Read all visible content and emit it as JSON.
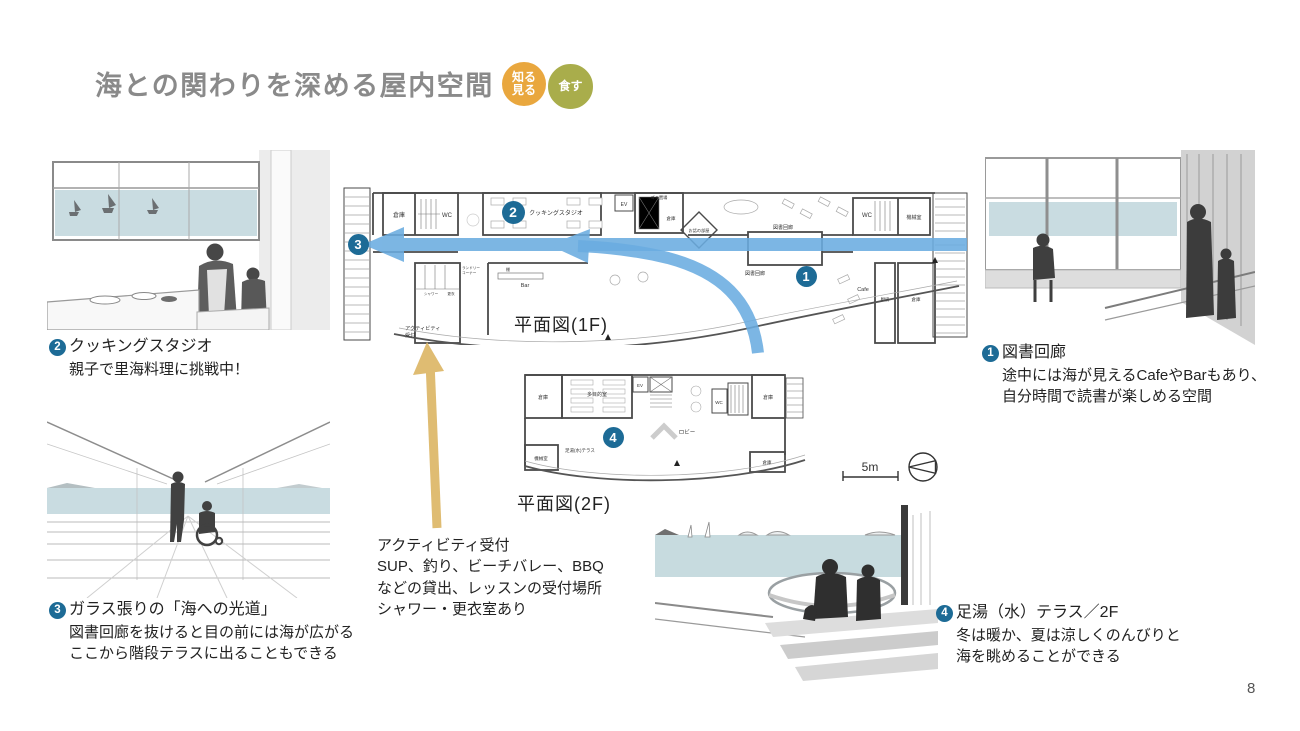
{
  "page": {
    "number": "8"
  },
  "title": {
    "text": "海との関わりを深める屋内空間"
  },
  "badges": [
    {
      "line1": "知る",
      "line2": "見る",
      "color": "#e9a73e"
    },
    {
      "line1": "食す",
      "color": "#a9ad4b"
    }
  ],
  "markers": {
    "m1": "1",
    "m2": "2",
    "m3": "3",
    "m4": "4"
  },
  "plan1f": {
    "caption": "平面図(1F)",
    "scale_label": "5m",
    "labels": {
      "storage_tl": "倉庫",
      "wc_left": "WC",
      "cooking_studio": "クッキングスタジオ",
      "ev": "EV",
      "gomi": "ゴミ置場",
      "storage_top": "倉庫",
      "story_room": "お話の部屋",
      "library_corridor_a": "図書回廊",
      "library_corridor_b": "図書回廊",
      "wc_right": "WC",
      "machine_room": "機械室",
      "cafe": "Cafe",
      "kitchen": "厨房",
      "storage_right": "倉庫",
      "bar": "Bar",
      "shelf": "棚",
      "shower": "シャワー",
      "locker": "更衣",
      "laundry_line1": "ランドリー",
      "laundry_line2": "コーナー",
      "activity_line1": "アクティビティ",
      "activity_line2": "受付"
    }
  },
  "plan2f": {
    "caption": "平面図(2F)",
    "labels": {
      "storage_left": "倉庫",
      "multi_room": "多目的室",
      "ev": "EV",
      "wc": "WC",
      "storage_right": "倉庫",
      "lobby": "ロビー",
      "machine_room": "機械室",
      "ashiyu_terrace": "足湯(水)テラス",
      "storage_br": "倉庫"
    }
  },
  "notes": {
    "note1": {
      "num": "1",
      "title": "図書回廊",
      "lines": [
        "途中には海が見えるCafeやBarもあり、",
        "自分時間で読書が楽しめる空間"
      ]
    },
    "note2": {
      "num": "2",
      "title": "クッキングスタジオ",
      "lines": [
        "親子で里海料理に挑戦中！"
      ]
    },
    "note3": {
      "num": "3",
      "title": "ガラス張りの「海への光道」",
      "lines": [
        "図書回廊を抜けると目の前には海が広がる",
        "ここから階段テラスに出ることもできる"
      ]
    },
    "note4": {
      "num": "4",
      "title": "足湯（水）テラス／2F",
      "lines": [
        "冬は暖か、夏は涼しくのんびりと",
        "海を眺めることができる"
      ]
    },
    "activity": {
      "title": "アクティビティ受付",
      "lines": [
        "SUP、釣り、ビーチバレー、BBQ",
        "などの貸出、レッスンの受付場所",
        "シャワー・更衣室あり"
      ]
    }
  },
  "colors": {
    "marker_blue": "#1d6b96",
    "arrow_blue": "#6aace0",
    "arrow_tan": "#dfbc72",
    "sea": "#c9dce1",
    "title_gray": "#8a8a8a"
  }
}
